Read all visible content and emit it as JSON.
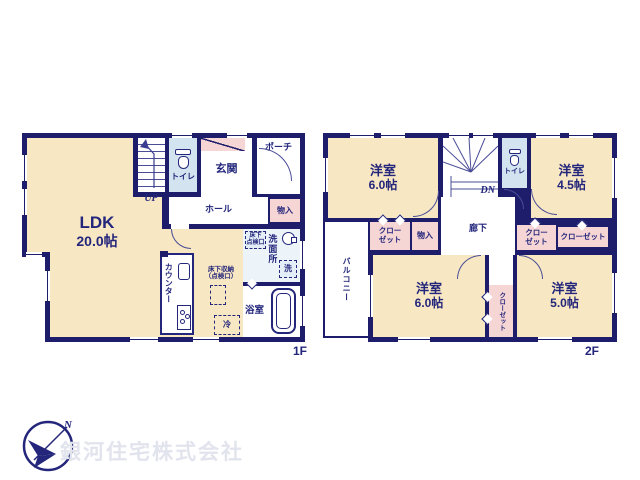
{
  "colors": {
    "wall": "#1d1d6b",
    "room": "#f7e7c3",
    "closet": "#f6d5d5",
    "wet": "#d3e3ef",
    "text": "#23267b",
    "watermark": "#e2e4ed"
  },
  "floor1": {
    "floor_label": "1F",
    "ldk_name": "LDK",
    "ldk_area": "20.0帖",
    "stairs_label": "UP",
    "toilet_label": "トイレ",
    "entrance_label": "玄関",
    "porch_label": "ポーチ",
    "hall_label": "ホール",
    "storage_label": "物入",
    "washroom_label": "洗面所",
    "washer_label": "洗",
    "bath_label": "浴室",
    "counter_label": "カウンター",
    "underfloor_hatch_line1": "床下",
    "underfloor_hatch_line2": "点検口",
    "underfloor_storage_line1": "床下収納",
    "underfloor_storage_line2": "（点検口）",
    "fridge_label": "冷"
  },
  "floor2": {
    "floor_label": "2F",
    "stairs_label": "DN",
    "toilet_label": "トイレ",
    "corridor_label": "廊下",
    "balcony_label": "バルコニー",
    "storage_label": "物入",
    "room_top_left": {
      "name": "洋室",
      "area": "6.0帖"
    },
    "room_top_right": {
      "name": "洋室",
      "area": "4.5帖"
    },
    "room_bottom_left": {
      "name": "洋室",
      "area": "6.0帖"
    },
    "room_bottom_right": {
      "name": "洋室",
      "area": "5.0帖"
    },
    "closet_a": {
      "line1": "クロー",
      "line2": "ゼット"
    },
    "closet_b": {
      "line1": "クロー",
      "line2": "ゼット"
    },
    "closet_c_label": "クローゼット",
    "closet_d_label": "クローゼット"
  },
  "branding": {
    "company_name": "銀河住宅株式会社",
    "compass_north": "N"
  }
}
